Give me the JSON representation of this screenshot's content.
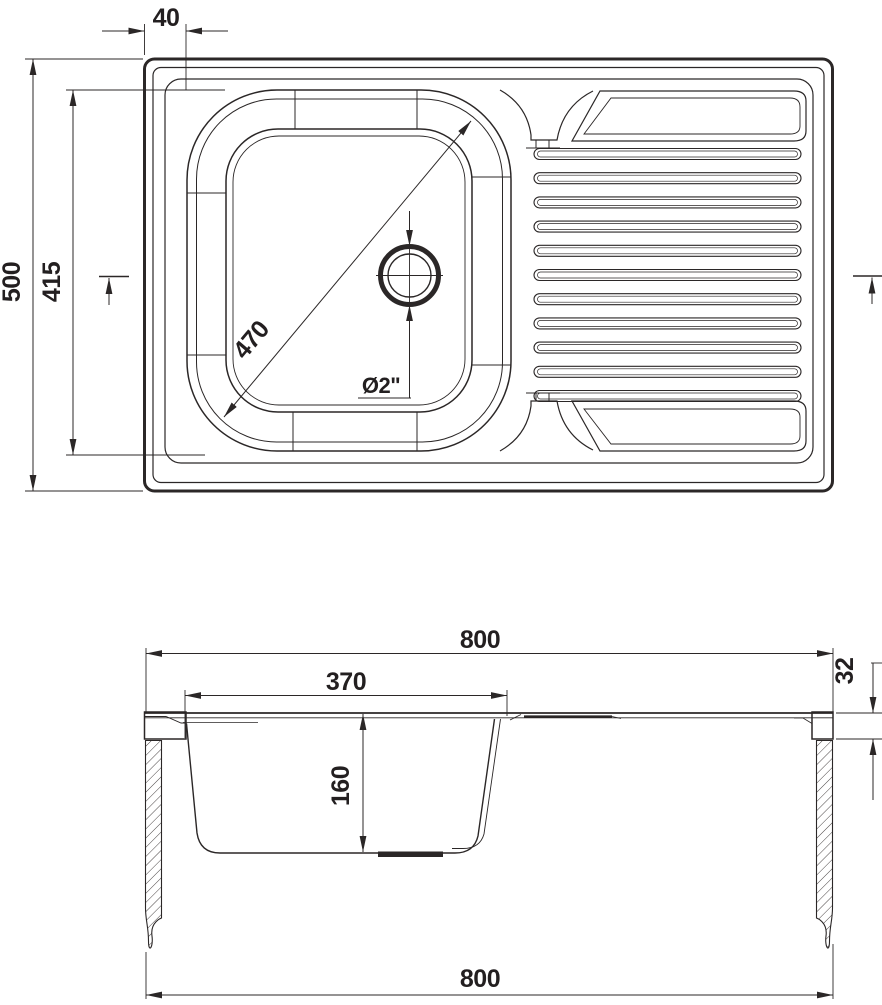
{
  "drawing": {
    "type": "technical-drawing",
    "subject": "kitchen sink with single bowl and drainboard",
    "line_color": "#2b2727",
    "background_color": "#ffffff",
    "views": {
      "top_view": {
        "name": "top view",
        "drainboard": {
          "rib_count": 11
        },
        "dimensions": {
          "edge_offset": "40",
          "overall_depth": "500",
          "inner_depth": "415",
          "bowl_diagonal": "470",
          "drain_diameter": "Ø2\""
        }
      },
      "section_view": {
        "name": "front section view",
        "dimensions": {
          "overall_width_top": "800",
          "bowl_width": "370",
          "bowl_depth": "160",
          "rim_height": "32",
          "overall_width_bottom": "800"
        }
      }
    }
  }
}
